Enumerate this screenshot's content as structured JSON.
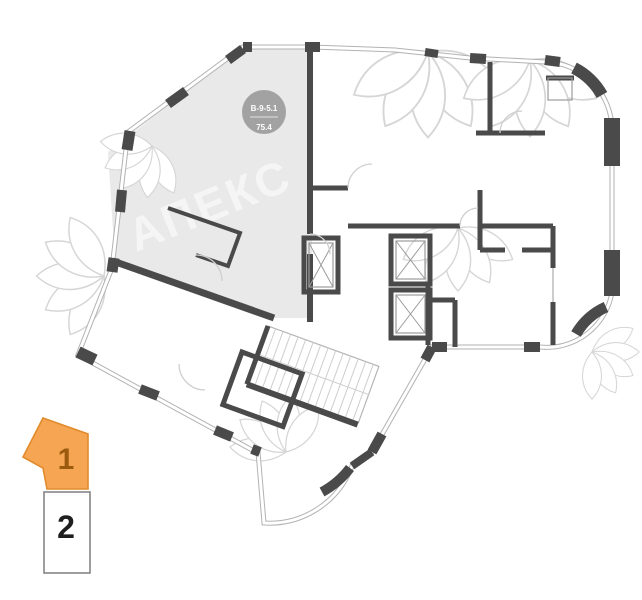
{
  "floor_plan": {
    "unit_badge": {
      "code": "В-9-5.1",
      "area": "75.4"
    },
    "watermark_text": "АПЕКС",
    "colors": {
      "wall": "#4a4a4b",
      "highlight_fill": "#e9e9e9",
      "badge_fill": "#9e9e9e",
      "window_line": "#b2b2b2"
    }
  },
  "floor_selector": {
    "floors": [
      {
        "label": "1",
        "selected": true
      },
      {
        "label": "2",
        "selected": false
      }
    ],
    "colors": {
      "selected_fill": "#f6a553",
      "selected_border": "#e18b2c",
      "selected_text": "#9c5a0f",
      "unselected_border": "#868686",
      "unselected_text": "#1f1f1f"
    }
  }
}
